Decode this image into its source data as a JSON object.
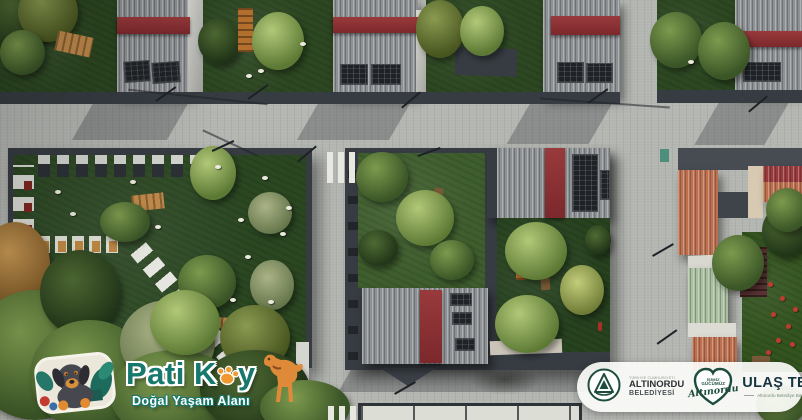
{
  "meta": {
    "title": "Pati Köy — Doğal Yaşam Alanı aerial 3D render"
  },
  "colors": {
    "road": "#b3b5b1",
    "wall": "#363c42",
    "grass": "#2c4721",
    "teal": "#17796d",
    "orange": "#f0992f",
    "munigreen": "#1e4d3e",
    "navy": "#16333f",
    "roofred": "#993a3c",
    "terracotta": "#bd7050",
    "roofgreen": "#a9bfa0",
    "flower": "#c23b30"
  },
  "branding": {
    "park": {
      "title_prefix": "Pati K",
      "title_suffix": "y",
      "subtitle": "Doğal Yaşam Alanı"
    },
    "municipality": {
      "country": "TÜRKİYE CUMHURİYETİ",
      "name": "ALTINORDU",
      "type": "BELEDİYESİ"
    },
    "slogan": {
      "line1": "İŞİMİZ",
      "line2": "GÜCÜMÜZ",
      "script": "Altınordu"
    },
    "mayor": {
      "name": "ULAŞ TEPE",
      "title": "Altınordu Belediye Başkanı"
    }
  }
}
